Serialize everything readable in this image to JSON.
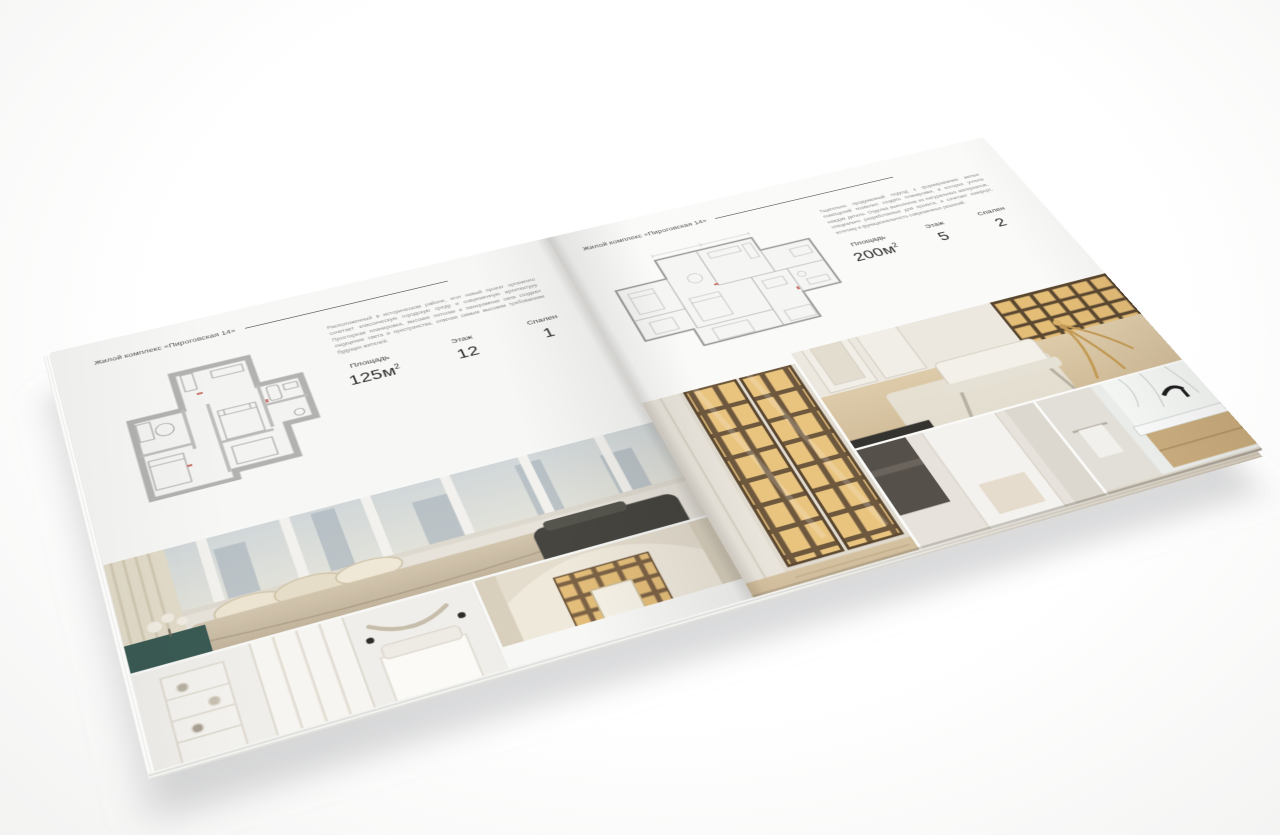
{
  "brochure": {
    "pages": [
      {
        "side": "left",
        "header": "Жилой комплекс «Пироговская 14»",
        "description": "Расположенный в историческом районе, этот новый проект органично сочетает классическую городскую среду и современную архитектуру. Просторная планировка, высокие потолки и панорамные окна создают ощущение света и пространства, отвечая самым высоким требованиям будущих жителей.",
        "stats": [
          {
            "label": "Площадь",
            "value": "125м",
            "sup": "2"
          },
          {
            "label": "Этаж",
            "value": "12"
          },
          {
            "label": "Спален",
            "value": "1"
          }
        ],
        "floor_plan": "one-bedroom-apartment-plan",
        "photos": [
          "bedroom-with-panoramic-windows",
          "white-bedroom-with-wardrobe",
          "arched-library-bedroom"
        ]
      },
      {
        "side": "right",
        "header": "Жилой комплекс «Пироговская 14»",
        "description": "Тщательно продуманный подход к формированию жилых помещений позволил создать планировки, в которых учтена каждая деталь. Отделка выполнена из натуральных материалов, специально разработанных для проекта, и сочетает комфорт, эстетику и функциональность современных решений.",
        "stats": [
          {
            "label": "Площадь",
            "value": "200м",
            "sup": "2"
          },
          {
            "label": "Этаж",
            "value": "5"
          },
          {
            "label": "Спален",
            "value": "2"
          }
        ],
        "floor_plan": "two-bedroom-apartment-plan",
        "photos": [
          "illuminated-wardrobe",
          "home-office-with-daybed",
          "hallway",
          "marble-bathroom"
        ]
      }
    ]
  },
  "palette": {
    "paper": "#f8f8f6",
    "ink": "#454543",
    "muted_text": "#8d8d8a",
    "plan_wall": "#b2b2b0",
    "photo_gold": "#e6c37f",
    "photo_wood": "#6e583d",
    "photo_beige": "#cfc2ab",
    "photo_dark": "#46453f",
    "photo_teal": "#3a5a54",
    "sky": "#c7d0d6",
    "marble": "#f3f5f3"
  }
}
